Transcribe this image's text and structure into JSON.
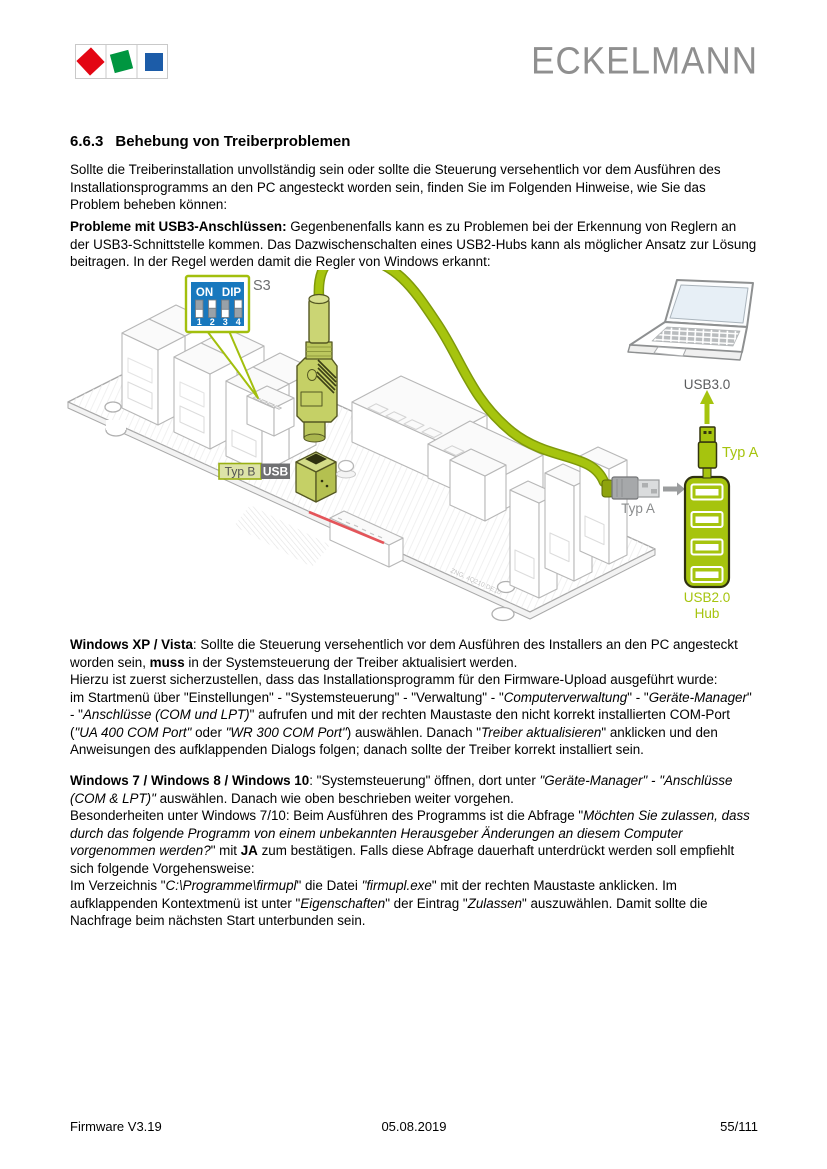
{
  "header": {
    "brand": "ECKELMANN",
    "logo_colors": {
      "red": "#e30613",
      "green": "#009640",
      "blue": "#1c5ca8"
    }
  },
  "heading": {
    "number": "6.6.3",
    "title": "Behebung von Treiberproblemen"
  },
  "paragraphs": {
    "p1": {
      "segments": [
        {
          "t": "Sollte die Treiberinstallation unvollständig sein oder sollte die Steuerung versehentlich vor dem Ausführen des Installationsprogramms an den PC angesteckt worden sein, finden Sie im Folgenden Hinweise, wie Sie das Problem beheben können:"
        }
      ]
    },
    "p2": {
      "segments": [
        {
          "t": "Probleme mit USB3-Anschlüssen:",
          "b": true
        },
        {
          "t": " Gegenbenenfalls kann es zu Problemen bei der Erkennung von Reglern an der USB3-Schnittstelle kommen. Das Dazwischenschalten eines USB2-Hubs kann als möglicher Ansatz zur Lösung beitragen. In der Regel werden damit die Regler von Windows erkannt:"
        }
      ]
    },
    "p3": {
      "segments": [
        {
          "t": "Windows XP / Vista",
          "b": true
        },
        {
          "t": ": Sollte die Steuerung versehentlich vor dem Ausführen des Installers an den PC angesteckt worden sein, "
        },
        {
          "t": "muss",
          "b": true
        },
        {
          "t": " in der Systemsteuerung der Treiber aktualisiert werden.\nHierzu ist zuerst sicherzustellen, dass das Installationsprogramm für den Firmware-Upload ausgeführt wurde:\nim Startmenü über \"Einstellungen\" - \"Systemsteuerung\" - \"Verwaltung\" - \""
        },
        {
          "t": "Computerverwaltung",
          "i": true
        },
        {
          "t": "\" - \""
        },
        {
          "t": "Geräte-Manager",
          "i": true
        },
        {
          "t": "\" - \""
        },
        {
          "t": "Anschlüsse (COM und LPT)",
          "i": true
        },
        {
          "t": "\" aufrufen und mit der rechten Maustaste den nicht korrekt installierten COM-Port ("
        },
        {
          "t": "\"UA 400 COM Port\"",
          "i": true
        },
        {
          "t": " oder "
        },
        {
          "t": "\"WR 300 COM Port\"",
          "i": true
        },
        {
          "t": ") auswählen. Danach \""
        },
        {
          "t": "Treiber aktualisieren",
          "i": true
        },
        {
          "t": "\" anklicken und den Anweisungen des aufklappenden Dialogs folgen; danach sollte der Treiber korrekt installiert sein."
        }
      ]
    },
    "p4": {
      "segments": [
        {
          "t": "Windows 7 / Windows 8 / Windows 10",
          "b": true
        },
        {
          "t": ": \"Systemsteuerung\" öffnen, dort unter "
        },
        {
          "t": "\"Geräte-Manager\" - \"Anschlüsse (COM & LPT)\"",
          "i": true
        },
        {
          "t": " auswählen. Danach wie oben beschrieben weiter vorgehen.\nBesonderheiten unter Windows 7/10: Beim Ausführen des Programms ist die Abfrage \""
        },
        {
          "t": "Möchten Sie zulassen, dass durch das folgende Programm von einem unbekannten Herausgeber Änderungen an diesem Computer vorgenommen werden?",
          "i": true
        },
        {
          "t": "\" mit "
        },
        {
          "t": "JA",
          "b": true
        },
        {
          "t": " zum bestätigen. Falls diese Abfrage dauerhaft unterdrückt werden soll empfiehlt sich folgende Vorgehensweise:\nIm Verzeichnis \""
        },
        {
          "t": "C:\\Programme\\firmupl",
          "i": true
        },
        {
          "t": "\" die Datei "
        },
        {
          "t": "\"firmupl.exe",
          "i": true
        },
        {
          "t": "\" mit der rechten Maustaste anklicken. Im aufklappenden Kontextmenü ist unter \""
        },
        {
          "t": "Eigenschaften",
          "i": true
        },
        {
          "t": "\" der Eintrag \""
        },
        {
          "t": "Zulassen",
          "i": true
        },
        {
          "t": "\" auszuwählen. Damit sollte die Nachfrage beim nächsten Start unterbunden sein."
        }
      ]
    }
  },
  "diagram": {
    "s3_ref": "S3",
    "dip": {
      "on": "ON",
      "dip": "DIP",
      "numbers": [
        "1",
        "2",
        "3",
        "4"
      ],
      "positions": [
        "down",
        "up",
        "down",
        "up"
      ]
    },
    "labels": {
      "typ_b": "Typ B",
      "usb": "USB",
      "typ_a_gray": "Typ A",
      "typ_a_green": "Typ A",
      "usb3": "USB3.0",
      "hub_line1": "USB2.0",
      "hub_line2": "Hub",
      "board_code": "ZNG. 4Q210 DE10"
    },
    "colors": {
      "green": "#a6c40e",
      "dip_blue": "#1878be",
      "red_line": "#e4555a"
    }
  },
  "footer": {
    "left": "Firmware V3.19",
    "center": "05.08.2019",
    "right": "55/111"
  }
}
